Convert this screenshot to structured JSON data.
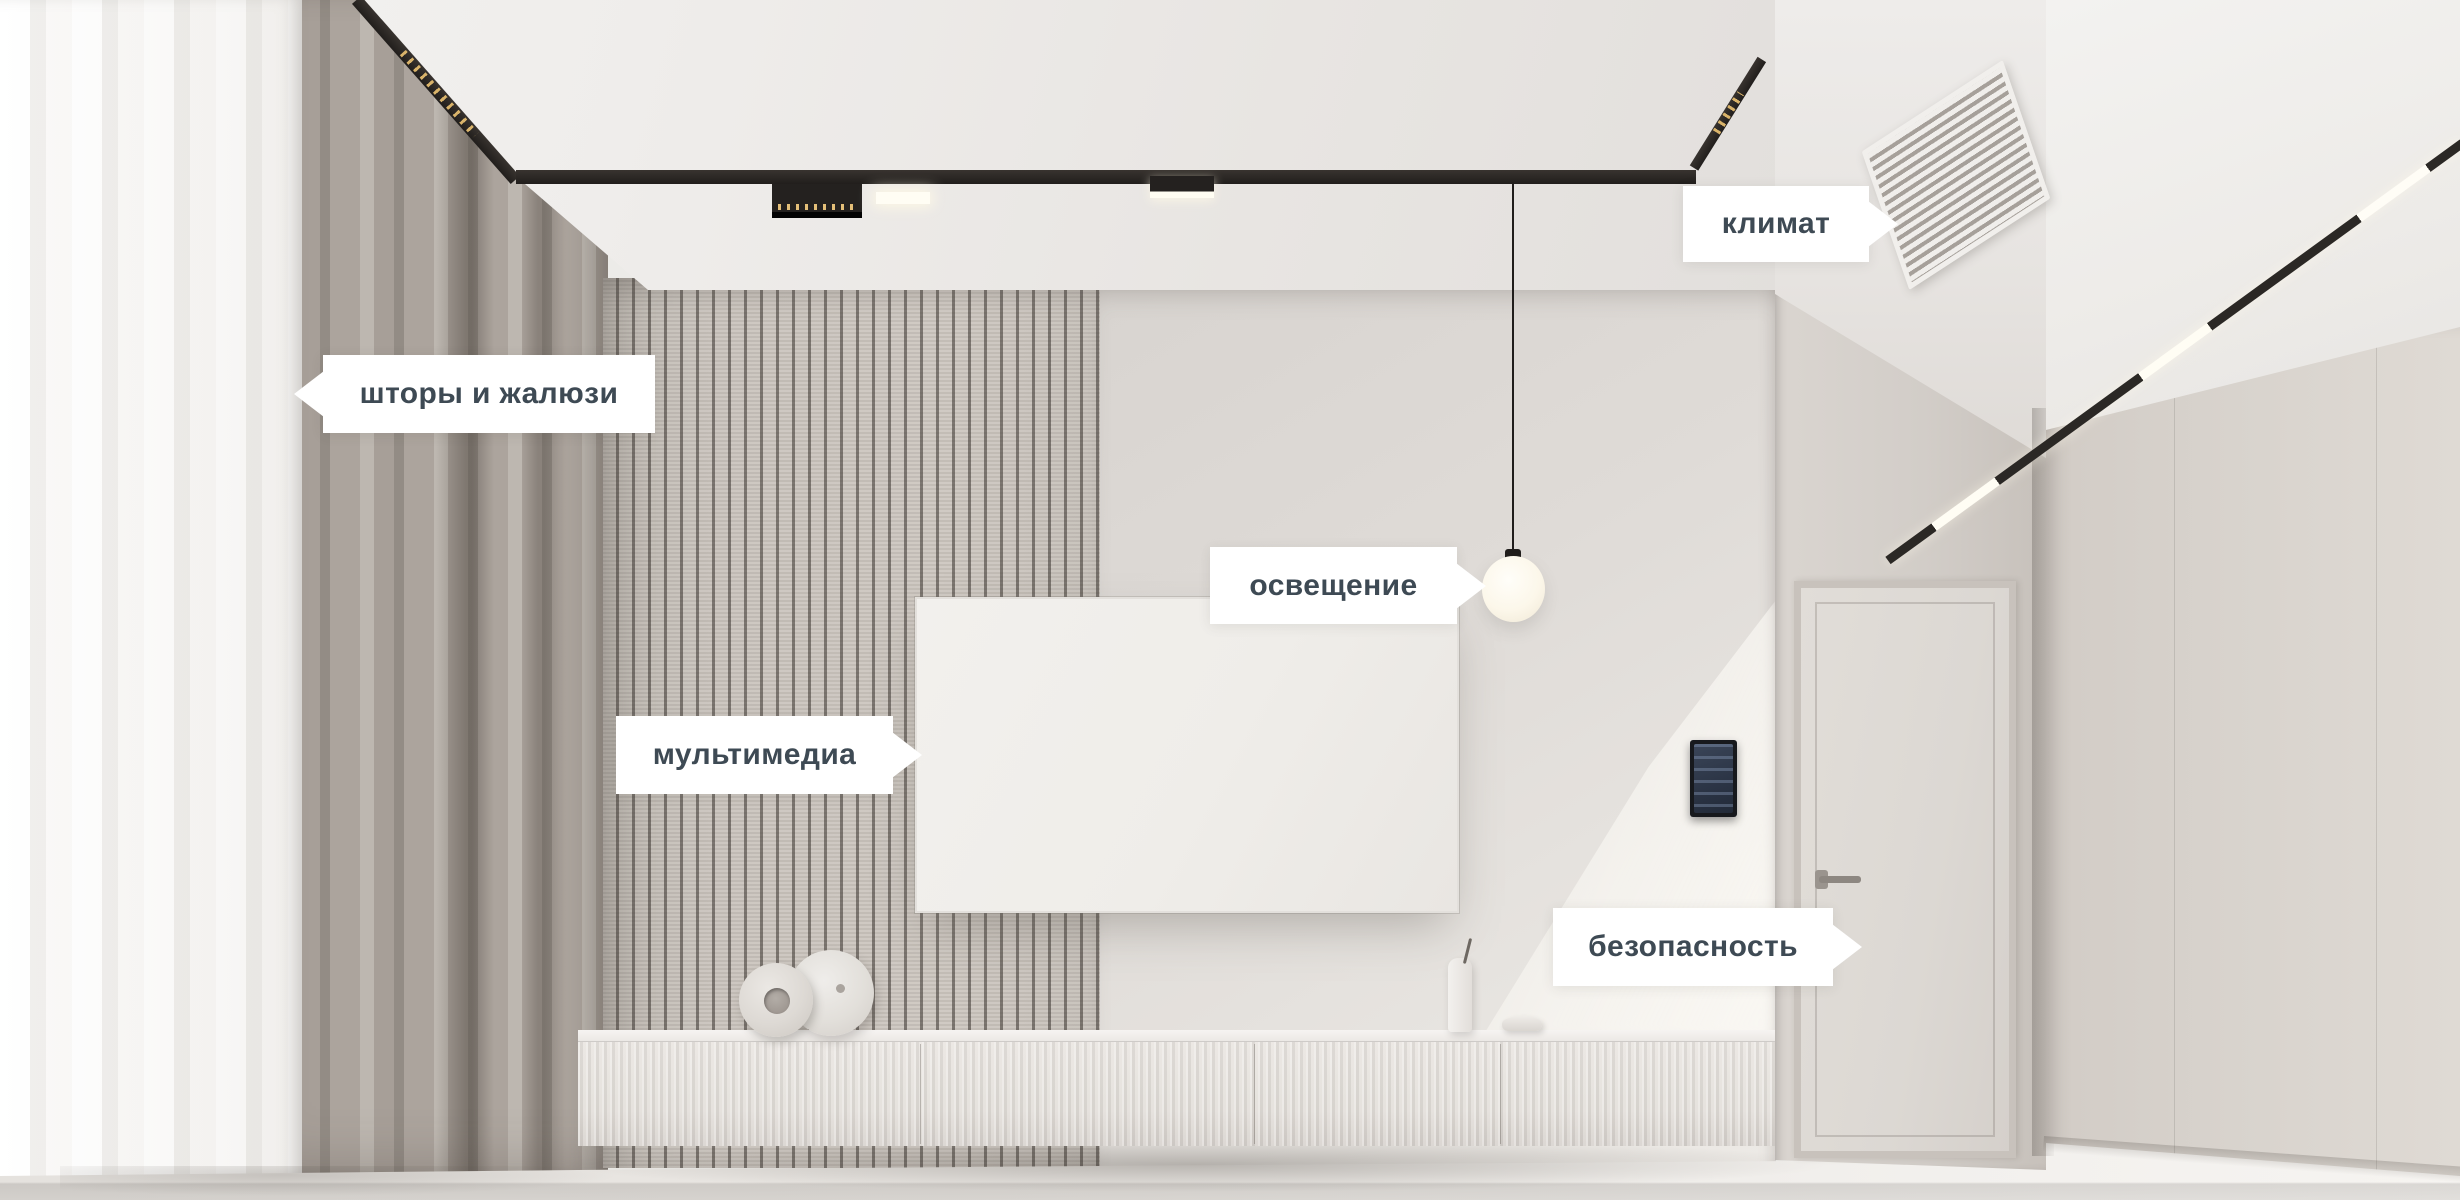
{
  "palette": {
    "label_bg": "#ffffff",
    "label_text": "#3e4a54",
    "track_black": "#2b2825",
    "led_warm": "#d9b36a",
    "wall_light": "#e2deda"
  },
  "callouts": [
    {
      "id": "curtains",
      "text": "шторы и жалюзи",
      "arrow": "left"
    },
    {
      "id": "climate",
      "text": "климат",
      "arrow": "right"
    },
    {
      "id": "lighting",
      "text": "освещение",
      "arrow": "right"
    },
    {
      "id": "multimedia",
      "text": "мультимедиа",
      "arrow": "right"
    },
    {
      "id": "security",
      "text": "безопасность",
      "arrow": "right"
    }
  ]
}
